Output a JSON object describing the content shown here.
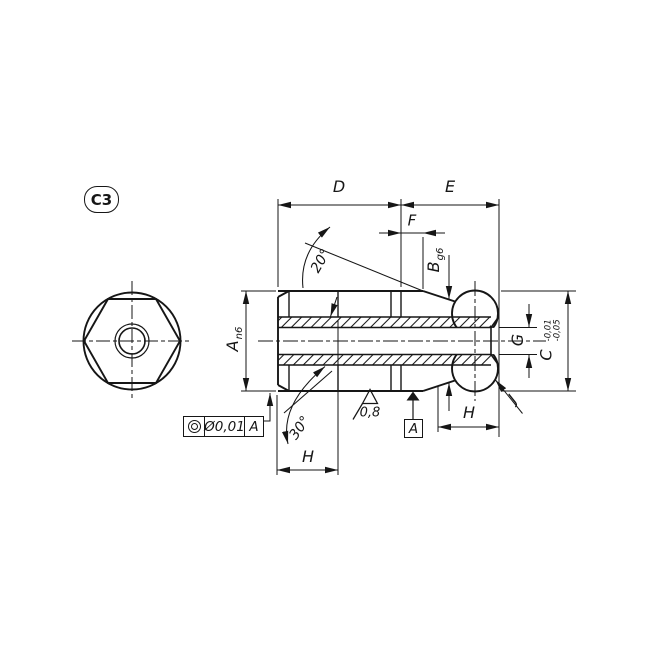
{
  "drawing": {
    "badge": "C3",
    "dimensions": {
      "d": "D",
      "e": "E",
      "f": "F",
      "h_hex": "H",
      "h_ball": "H",
      "g": "G",
      "j": "J",
      "a_letter": "A",
      "a_fit": "n6",
      "b_letter": "B",
      "b_fit": "g6",
      "c_letter": "C",
      "c_tol_upper": "-0,01",
      "c_tol_lower": "-0,05"
    },
    "angles": {
      "taper": "20°",
      "chamfer": "30°"
    },
    "surface_finish": "0,8",
    "datum": "A",
    "feature_control_frame": {
      "symbol": "concentricity",
      "tolerance": "Ø0,01",
      "datum": "A"
    },
    "colors": {
      "line": "#161616",
      "background": "#ffffff"
    }
  }
}
